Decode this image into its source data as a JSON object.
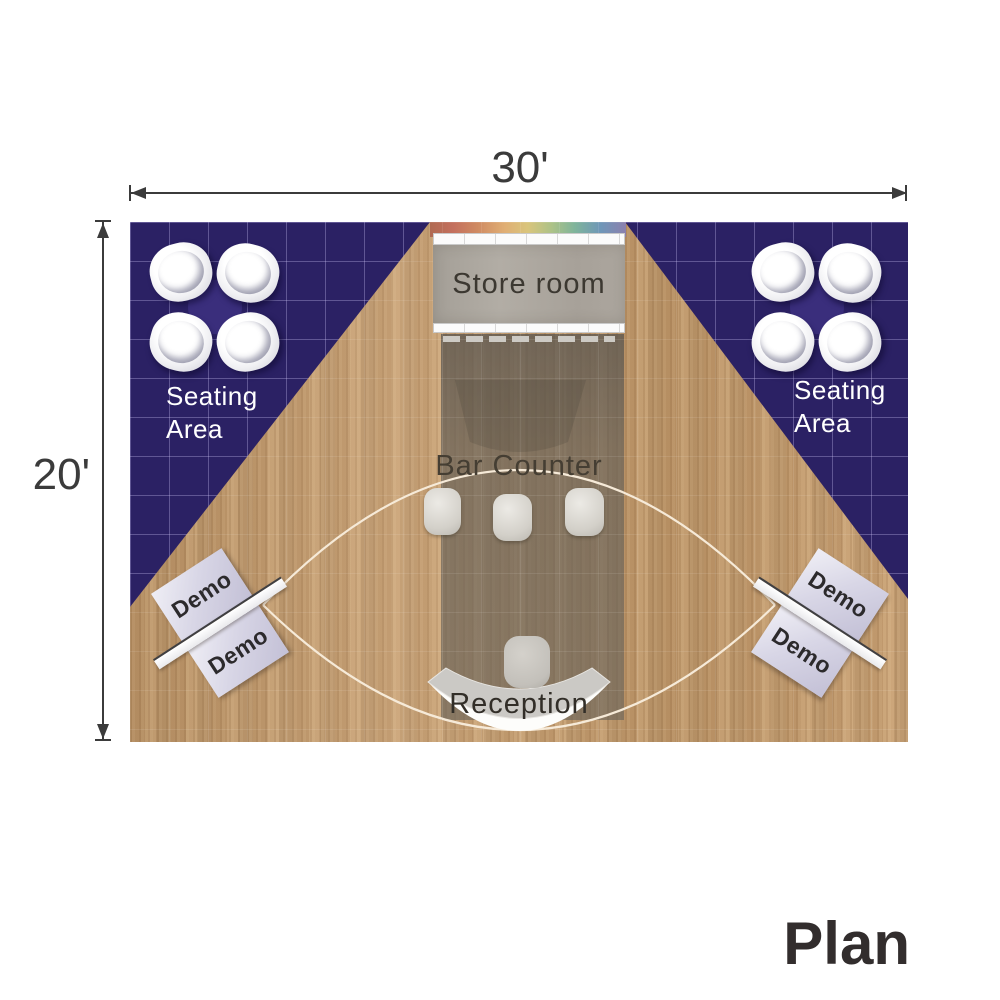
{
  "plan_title": "Plan",
  "dimensions": {
    "width": "30'",
    "height": "20'"
  },
  "areas": {
    "store_room": "Store room",
    "bar_counter": "Bar Counter",
    "reception": "Reception",
    "seating_left": {
      "line1": "Seating",
      "line2": "Area"
    },
    "seating_right": {
      "line1": "Seating",
      "line2": "Area"
    },
    "demo_left": [
      "Demo",
      "Demo"
    ],
    "demo_right": [
      "Demo",
      "Demo"
    ]
  },
  "colors": {
    "carpet": "#2b2164",
    "carpet_grid": "#afa4e8",
    "wood_floor": "#c59c6d",
    "booth_band": "#6b665e",
    "store_room_gray": "#a9a49c",
    "demo_station": "#d8d6e6",
    "walkway_curve": "#f6ead8",
    "dimension_ink": "#3b3b3b",
    "label_light": "#ffffff",
    "label_dark": "#3c3831",
    "rainbow_strip": "linear red-orange-yellow-green-blue-violet"
  }
}
